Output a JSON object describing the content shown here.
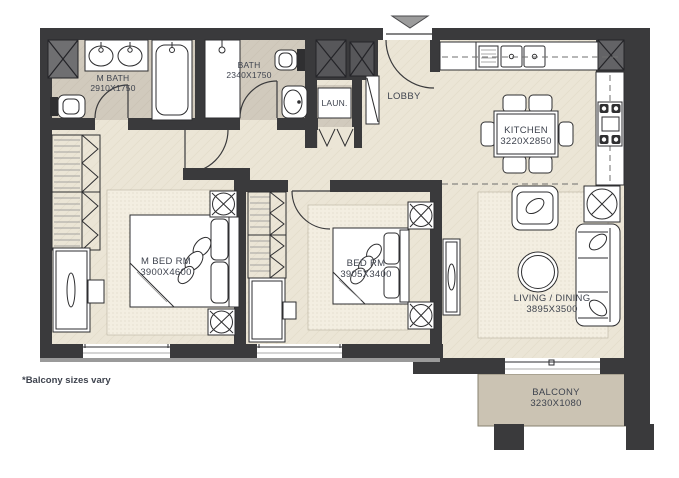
{
  "note": "*Balcony sizes vary",
  "colors": {
    "wall": "#3a3a3c",
    "floor": "#ebe5d6",
    "bath_floor": "#d1cabd",
    "balcony_floor": "#cbc3b3",
    "column_light": "#6f6f71",
    "column_dark": "#57575a",
    "column_mid": "#636366",
    "label_text": "#3e434e",
    "entry_arrow": "#9c9c9c"
  },
  "rooms": {
    "master_bath": {
      "name": "M BATH",
      "dims": "2910X1750"
    },
    "bath": {
      "name": "BATH",
      "dims": "2340X1750"
    },
    "laundry": {
      "name": "LAUN."
    },
    "lobby": {
      "name": "LOBBY"
    },
    "kitchen": {
      "name": "KITCHEN",
      "dims": "3220X2850"
    },
    "master_bedroom": {
      "name": "M BED RM",
      "dims": "3900X4600"
    },
    "bedroom": {
      "name": "BED RM",
      "dims": "3905X3400"
    },
    "living_dining": {
      "name": "LIVING / DINING",
      "dims": "3895X3500"
    },
    "balcony": {
      "name": "BALCONY",
      "dims": "3230X1080"
    }
  }
}
